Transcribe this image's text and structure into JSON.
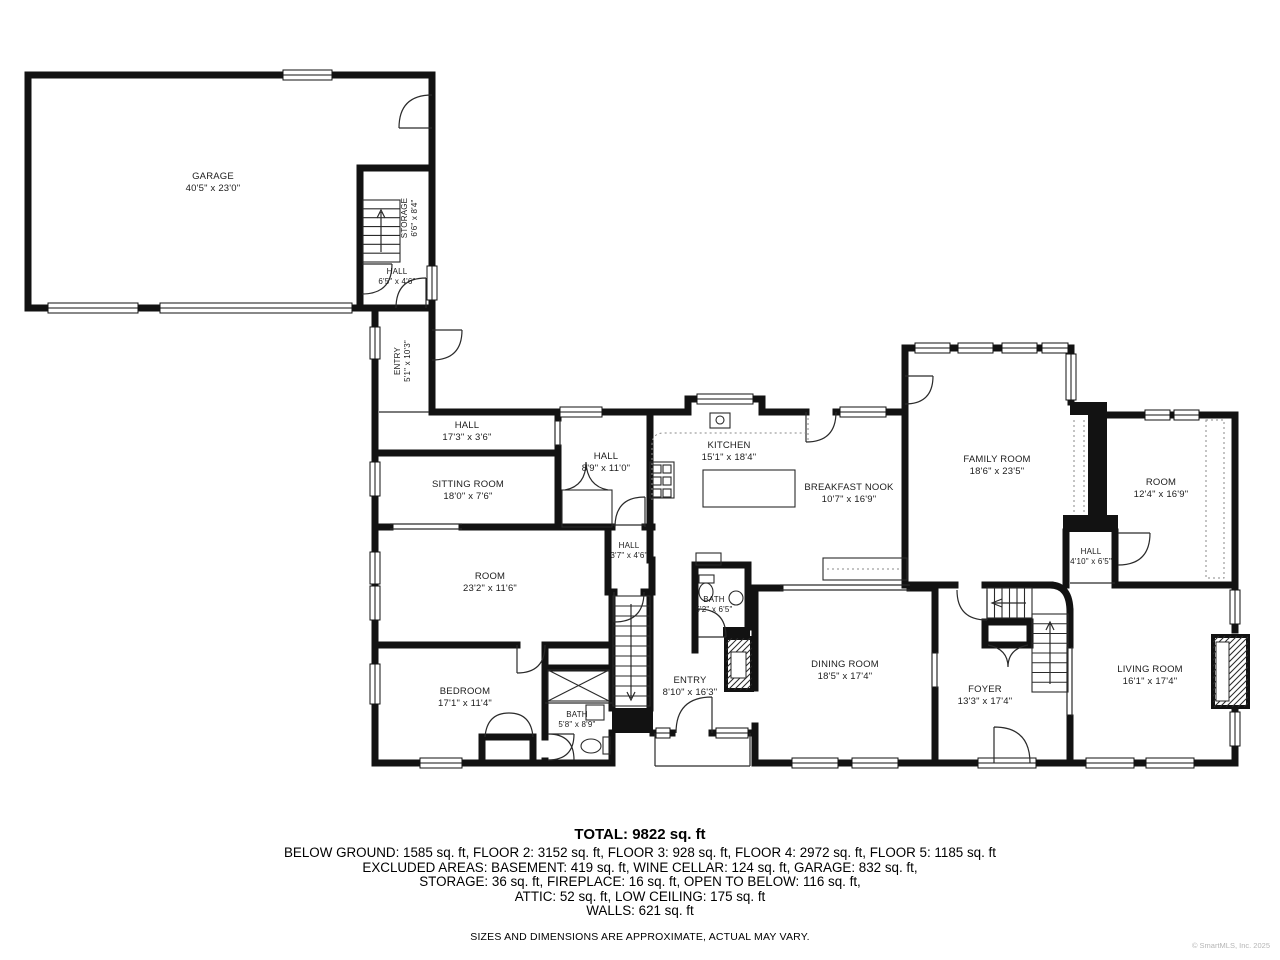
{
  "plan": {
    "rooms": [
      {
        "name": "GARAGE",
        "dims": "40'5\" x 23'0\""
      },
      {
        "name": "STORAGE",
        "dims": "6'6\" x 8'4\""
      },
      {
        "name": "HALL",
        "dims": "6'5\" x 4'6\""
      },
      {
        "name": "ENTRY",
        "dims": "5'1\" x 10'3\""
      },
      {
        "name": "HALL",
        "dims": "17'3\" x 3'6\""
      },
      {
        "name": "SITTING ROOM",
        "dims": "18'0\" x 7'6\""
      },
      {
        "name": "HALL",
        "dims": "8'9\" x 11'0\""
      },
      {
        "name": "KITCHEN",
        "dims": "15'1\" x 18'4\""
      },
      {
        "name": "BREAKFAST NOOK",
        "dims": "10'7\" x 16'9\""
      },
      {
        "name": "FAMILY ROOM",
        "dims": "18'6\" x 23'5\""
      },
      {
        "name": "ROOM",
        "dims": "12'4\" x 16'9\""
      },
      {
        "name": "HALL",
        "dims": "4'10\" x 6'5\""
      },
      {
        "name": "HALL",
        "dims": "3'7\" x 4'6\""
      },
      {
        "name": "ROOM",
        "dims": "23'2\" x 11'6\""
      },
      {
        "name": "BATH",
        "dims": "5'2\" x 6'5\""
      },
      {
        "name": "BEDROOM",
        "dims": "17'1\" x 11'4\""
      },
      {
        "name": "ENTRY",
        "dims": "8'10\" x 16'3\""
      },
      {
        "name": "DINING ROOM",
        "dims": "18'5\" x 17'4\""
      },
      {
        "name": "FOYER",
        "dims": "13'3\" x 17'4\""
      },
      {
        "name": "LIVING ROOM",
        "dims": "16'1\" x 17'4\""
      },
      {
        "name": "BATH",
        "dims": "5'8\" x 8'9\""
      }
    ]
  },
  "footer": {
    "total": "TOTAL: 9822 sq. ft",
    "lines": [
      "BELOW GROUND: 1585 sq. ft, FLOOR 2: 3152 sq. ft, FLOOR 3: 928 sq. ft, FLOOR 4: 2972 sq. ft, FLOOR 5: 1185 sq. ft",
      "EXCLUDED AREAS: BASEMENT: 419 sq. ft, WINE CELLAR: 124 sq. ft, GARAGE: 832 sq. ft,",
      "STORAGE: 36 sq. ft, FIREPLACE: 16 sq. ft, OPEN TO BELOW: 116 sq. ft,",
      "ATTIC: 52 sq. ft, LOW CEILING: 175 sq. ft",
      "WALLS: 621 sq. ft"
    ],
    "disclaimer": "SIZES AND DIMENSIONS ARE APPROXIMATE, ACTUAL MAY VARY.",
    "copyright": "© SmartMLS, Inc. 2025"
  },
  "colors": {
    "wall": "#121212",
    "thin": "#2a2a2a",
    "dash": "#8a8a8a"
  }
}
